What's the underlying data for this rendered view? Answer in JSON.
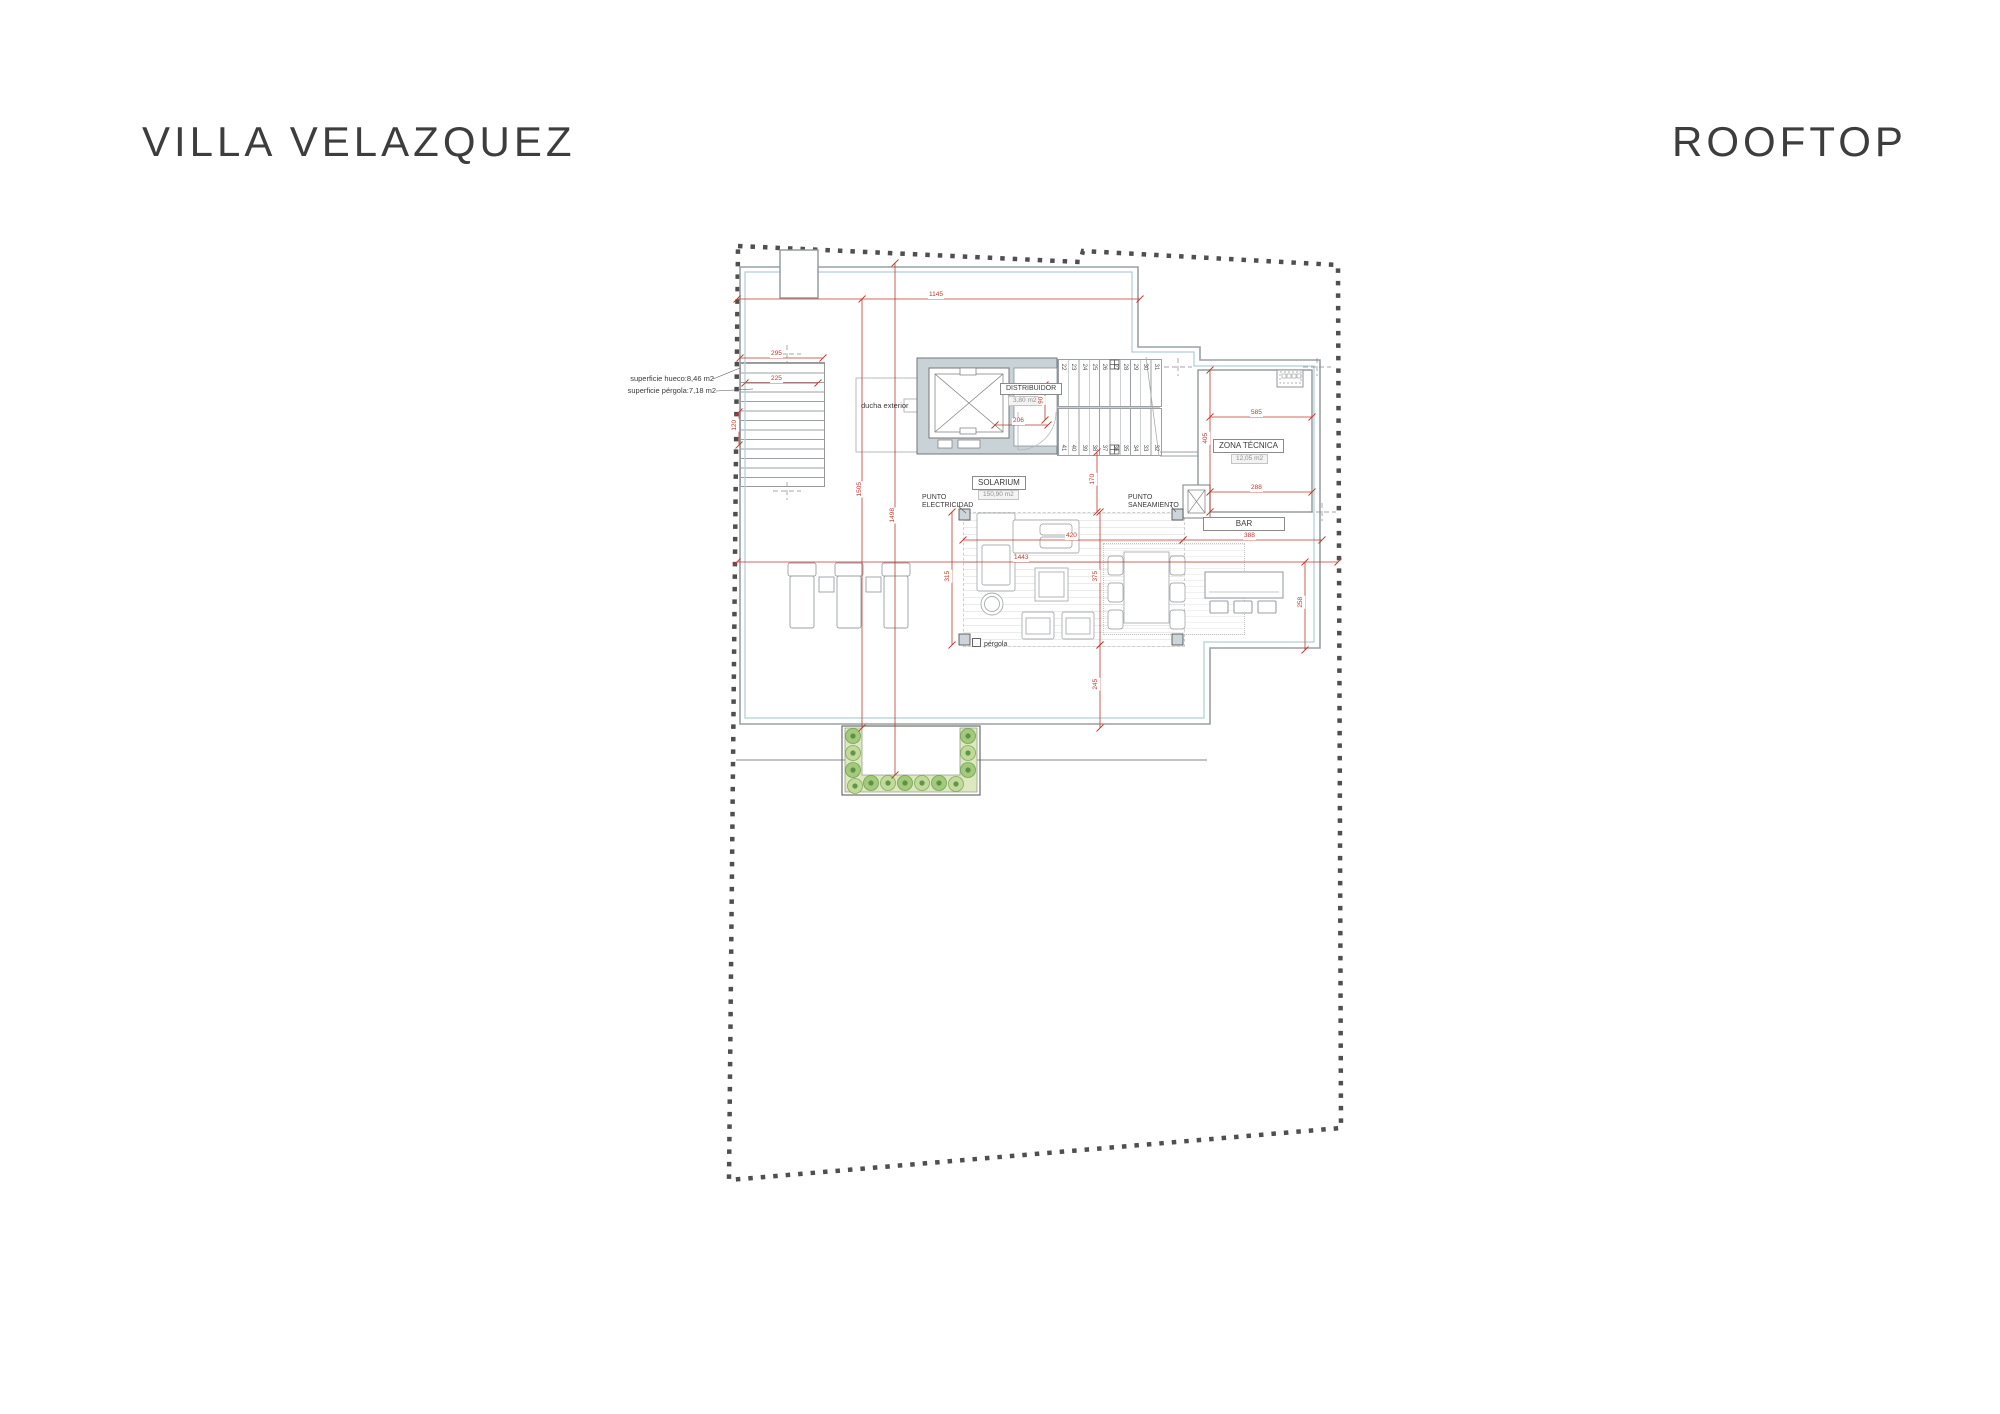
{
  "page": {
    "title_left": "VILLA VELAZQUEZ",
    "title_right": "ROOFTOP"
  },
  "plan": {
    "rooms": {
      "distribuidor": {
        "name": "DISTRIBUIDOR",
        "area": "3,80 m2"
      },
      "solarium": {
        "name": "SOLARIUM",
        "area": "150,90 m2"
      },
      "zona_tecnica": {
        "name": "ZONA TÉCNICA",
        "area": "12,05 m2"
      },
      "bar": {
        "name": "BAR"
      }
    },
    "annotations": {
      "superficie_hueco": "superficie hueco:8,46 m2",
      "superficie_pergola": "superficie pérgola:7,18 m2",
      "ducha_exterior": "ducha exterior",
      "punto_electricidad_l1": "PUNTO",
      "punto_electricidad_l2": "ELECTRICIDAD",
      "punto_saneamiento_l1": "PUNTO",
      "punto_saneamiento_l2": "SANEAMIENTO",
      "pergola_label": "pérgola"
    },
    "dimensions": [
      {
        "value": "1145"
      },
      {
        "value": "1505"
      },
      {
        "value": "1498"
      },
      {
        "value": "295"
      },
      {
        "value": "225"
      },
      {
        "value": "120"
      },
      {
        "value": "206"
      },
      {
        "value": "90"
      },
      {
        "value": "585"
      },
      {
        "value": "405"
      },
      {
        "value": "288"
      },
      {
        "value": "170"
      },
      {
        "value": "420"
      },
      {
        "value": "388"
      },
      {
        "value": "1443"
      },
      {
        "value": "315"
      },
      {
        "value": "375"
      },
      {
        "value": "245"
      },
      {
        "value": "258"
      }
    ],
    "stairs": {
      "top_run": [
        "22",
        "23",
        "24",
        "25",
        "26",
        "27",
        "28",
        "29",
        "30",
        "31"
      ],
      "bottom_run": [
        "41",
        "40",
        "39",
        "38",
        "37",
        "36",
        "35",
        "34",
        "33",
        "32"
      ]
    },
    "colors": {
      "dimension_red": "#c0392b",
      "wall_gray": "#c9d2d7",
      "roof_line": "#9aa0a3",
      "accent_blue": "#b5cfd8",
      "boundary_gray": "#4f4f4f",
      "planter_fill": "#dde7c0",
      "plant_green": "#6aa84f"
    }
  }
}
